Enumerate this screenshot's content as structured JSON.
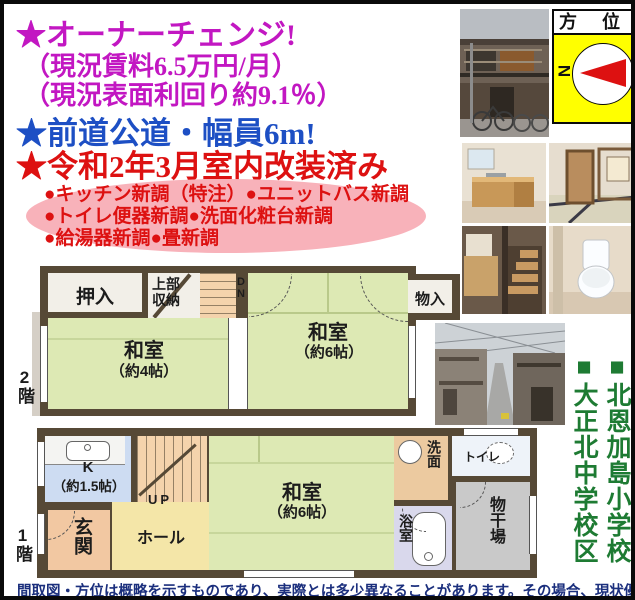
{
  "headline": {
    "owner_change": "★オーナーチェンジ!",
    "rent": "（現況賃料6.5万円/月）",
    "yield": "（現況表面利回り約9.1％）",
    "road": "★前道公道・幅員6m!",
    "renovated": "★令和2年3月室内改装済み"
  },
  "renovation_items": {
    "line1": "●キッチン新調（特注）●ユニットバス新調",
    "line2": "●トイレ便器新調●洗面化粧台新調",
    "line3": "●給湯器新調●畳新調"
  },
  "compass": {
    "title": "方 位",
    "north_label": "N"
  },
  "schools": {
    "elementary": "■北恩加島小学校",
    "junior_high": "■大正北中学校区"
  },
  "floor2": {
    "floor_label": "2階",
    "closet": "押入",
    "upper_storage": "上部収納",
    "down": "DN",
    "washitsu4": "和室",
    "washitsu4_size": "（約4帖）",
    "washitsu6": "和室",
    "washitsu6_size": "（約6帖）",
    "storage": "物入"
  },
  "floor1": {
    "floor_label": "1階",
    "kitchen": "K",
    "kitchen_size": "（約1.5帖）",
    "up": "UP",
    "entrance": "玄関",
    "hall": "ホール",
    "washitsu6": "和室",
    "washitsu6_size": "（約6帖）",
    "washroom": "洗面",
    "toilet": "トイレ",
    "bath": "浴室",
    "drying_area": "物干場"
  },
  "disclaimer": "間取図・方位は概略を示すものであり、実際とは多少異なることがあります。その場合、現状優先です。",
  "icons": {
    "compass_needle": "north-arrow-pointing-left",
    "photo_set": [
      "house-exterior-photo",
      "kitchen-photo",
      "tatami-room-photo",
      "staircase-photo",
      "toilet-photo",
      "street-photo"
    ]
  },
  "colors": {
    "magenta": "#c217c2",
    "blue": "#1d4fc4",
    "red": "#dd1111",
    "pink_ellipse": "#f8b2ba",
    "school_green": "#1e7b33",
    "tatami_green": "#dde9b4",
    "wall_brown": "#564936",
    "compass_yellow": "#ffff00"
  }
}
